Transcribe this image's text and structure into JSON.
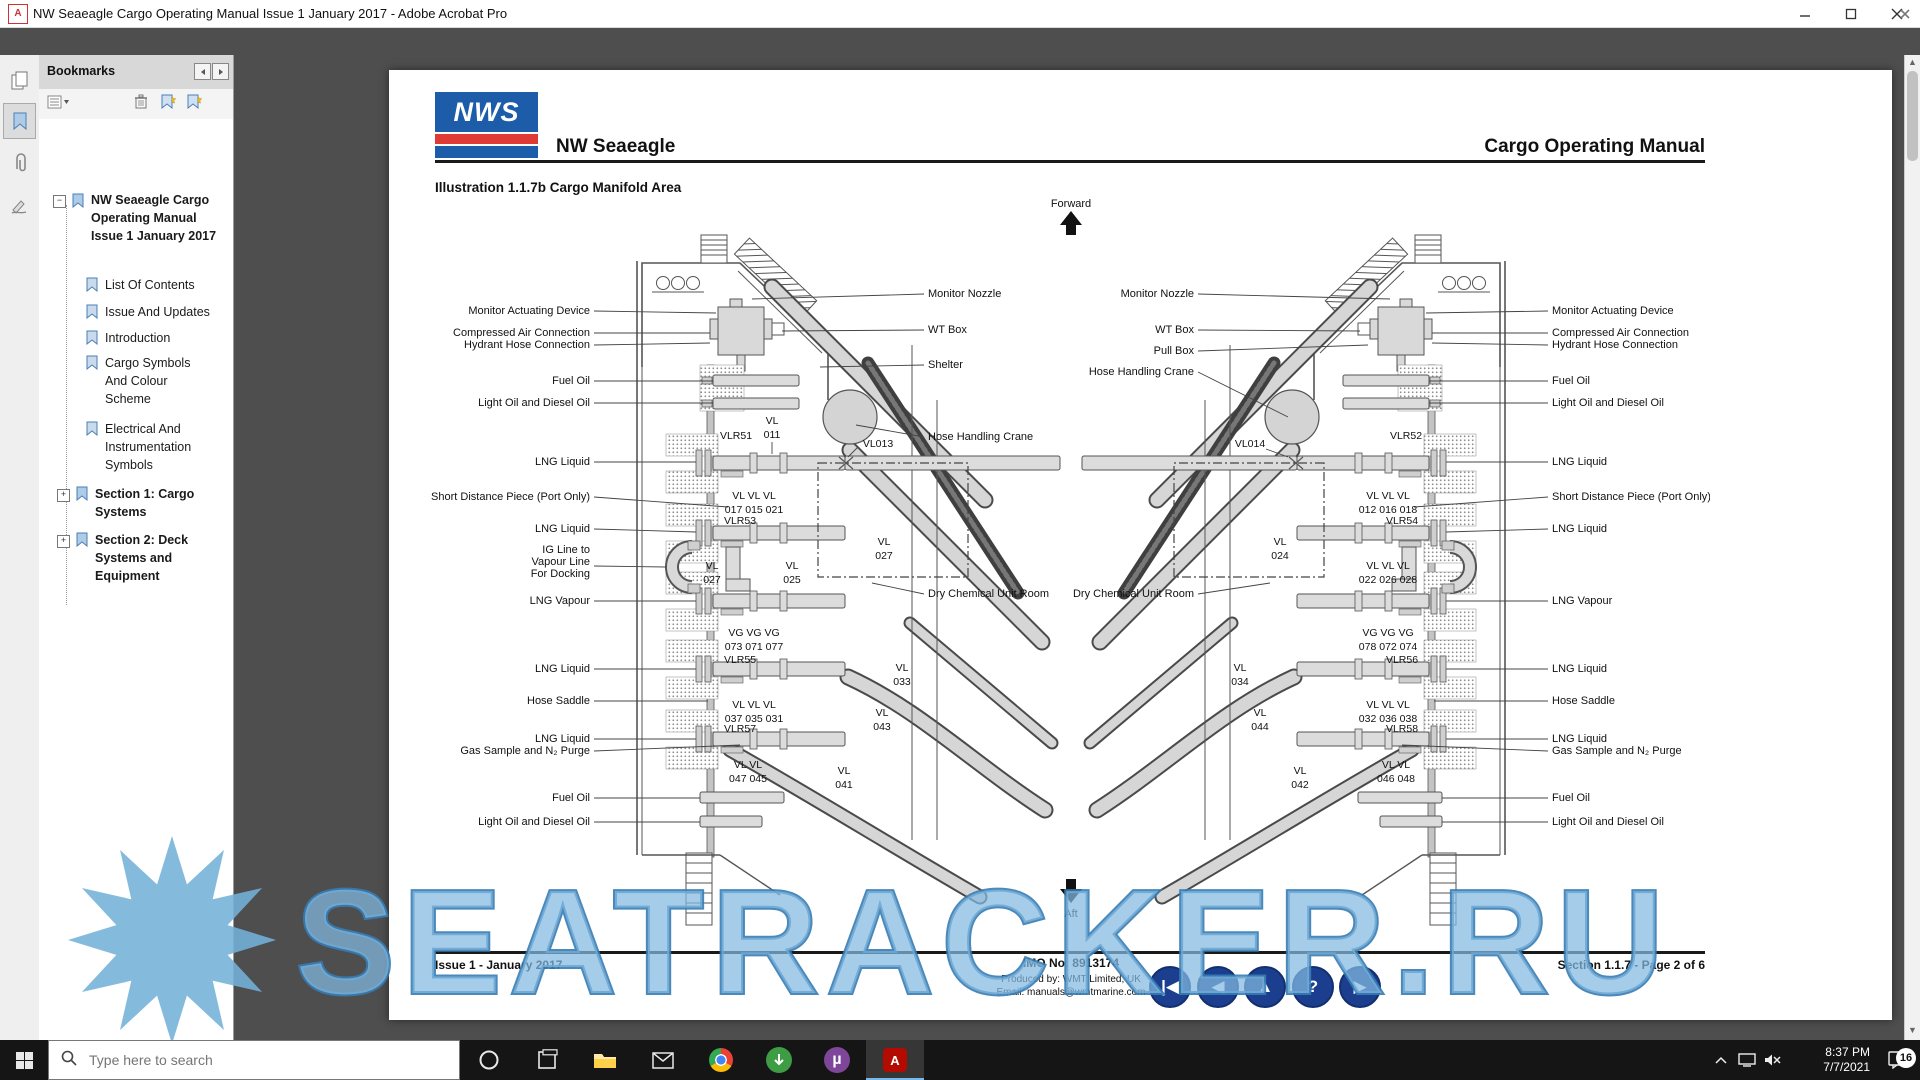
{
  "window": {
    "title": "NW Seaeagle Cargo Operating Manual Issue 1 January 2017 - Adobe Acrobat Pro"
  },
  "menubar": {
    "items": [
      "File",
      "Edit",
      "View",
      "Window",
      "Help"
    ]
  },
  "sidebar": {
    "panel_title": "Bookmarks",
    "root_bookmark": "NW Seaeagle Cargo Operating Manual Issue 1 January 2017",
    "bookmarks": [
      "List Of Contents",
      "Issue And Updates",
      "Introduction",
      "Cargo Symbols And Colour Scheme",
      "Electrical And Instrumentation Symbols",
      "Section 1: Cargo Systems",
      "Section 2: Deck Systems and Equipment"
    ]
  },
  "page": {
    "logo": "NWS",
    "ship": "NW Seaeagle",
    "manual_title": "Cargo Operating Manual",
    "illustration": "Illustration 1.1.7b Cargo Manifold Area",
    "nav_glyphs": [
      "|◀",
      "◀",
      "▲",
      "?",
      "▶"
    ]
  },
  "footer": {
    "issue": "Issue 1 - January 2017",
    "imo": "IMO No: 8913174",
    "produced": "Produced by: WMT Limited, UK",
    "email": "Email: manuals@wmtmarine.com",
    "section": "Section 1.1.7 - Page 2 of 6"
  },
  "diagram": {
    "forward": "Forward",
    "aft": "Aft",
    "port": {
      "callouts_left": [
        "Monitor Actuating Device",
        "Compressed Air Connection",
        "Hydrant Hose Connection",
        "Fuel Oil",
        "Light Oil and Diesel Oil",
        "LNG Liquid",
        "Short Distance Piece (Port Only)",
        "LNG Liquid",
        "IG Line to",
        "Vapour Line",
        "For Docking",
        "LNG Vapour",
        "LNG Liquid",
        "Hose Saddle",
        "LNG Liquid",
        "Gas Sample and N₂ Purge",
        "Fuel Oil",
        "Light Oil and Diesel Oil"
      ],
      "callouts_right": [
        "Monitor Nozzle",
        "WT Box",
        "Shelter",
        "Hose Handling Crane",
        "Dry Chemical Unit Room"
      ]
    },
    "port_valves": {
      "vlr51": "VLR51",
      "vl011": [
        "VL",
        "011"
      ],
      "vl013": "VL013",
      "row1": [
        "VL    VL   VL",
        "017  015  021"
      ],
      "vlr53": "VLR53",
      "vl027a": [
        "VL",
        "027"
      ],
      "vl025": [
        "VL",
        "025"
      ],
      "vl027b": [
        "VL",
        "027"
      ],
      "vg_row": [
        "VG   VG   VG",
        "073  071  077"
      ],
      "vlr55": "VLR55",
      "vl033": [
        "VL",
        "033"
      ],
      "row2": [
        "VL    VL   VL",
        "037  035  031"
      ],
      "vl043": [
        "VL",
        "043"
      ],
      "vlr57": "VLR57",
      "row3": [
        "VL    VL",
        "047  045"
      ],
      "vl041": [
        "VL",
        "041"
      ]
    },
    "stbd": {
      "callouts_left": [
        "Monitor Nozzle",
        "WT Box",
        "Pull Box",
        "Hose Handling Crane",
        "Dry Chemical Unit Room"
      ],
      "callouts_right": [
        "Monitor Actuating Device",
        "Compressed Air Connection",
        "Hydrant Hose Connection",
        "Fuel Oil",
        "Light Oil and Diesel Oil",
        "LNG Liquid",
        "Short Distance Piece (Port Only)",
        "LNG Liquid",
        "LNG Vapour",
        "LNG Liquid",
        "Hose Saddle",
        "LNG Liquid",
        "Gas Sample and N₂ Purge",
        "Fuel Oil",
        "Light Oil and Diesel Oil"
      ]
    },
    "stbd_valves": {
      "vl014": "VL014",
      "vlr52": "VLR52",
      "row1": [
        "VL    VL   VL",
        "012  016  018"
      ],
      "vlr54": "VLR54",
      "vl024": [
        "VL",
        "024"
      ],
      "row2": [
        "VL    VL   VL",
        "022  026  028"
      ],
      "vg_row": [
        "VG   VG   VG",
        "078  072  074"
      ],
      "vlr56": "VLR56",
      "vl034": [
        "VL",
        "034"
      ],
      "row3": [
        "VL    VL   VL",
        "032  036  038"
      ],
      "vlr58": "VLR58",
      "vl044": [
        "VL",
        "044"
      ],
      "row4": [
        "VL    VL",
        "046  048"
      ],
      "vl042": [
        "VL",
        "042"
      ]
    }
  },
  "watermark": {
    "text": "SEATRACKER.RU"
  },
  "taskbar": {
    "search_placeholder": "Type here to search",
    "time": "8:37 PM",
    "date": "7/7/2021",
    "notif_count": "16"
  },
  "colors": {
    "logo_blue": "#1c5ca8",
    "logo_red": "#df3a33",
    "nav_button_blue": "#1b3e8f",
    "watermark_blue": "#7db8df",
    "taskbar_dark": "#151515"
  }
}
